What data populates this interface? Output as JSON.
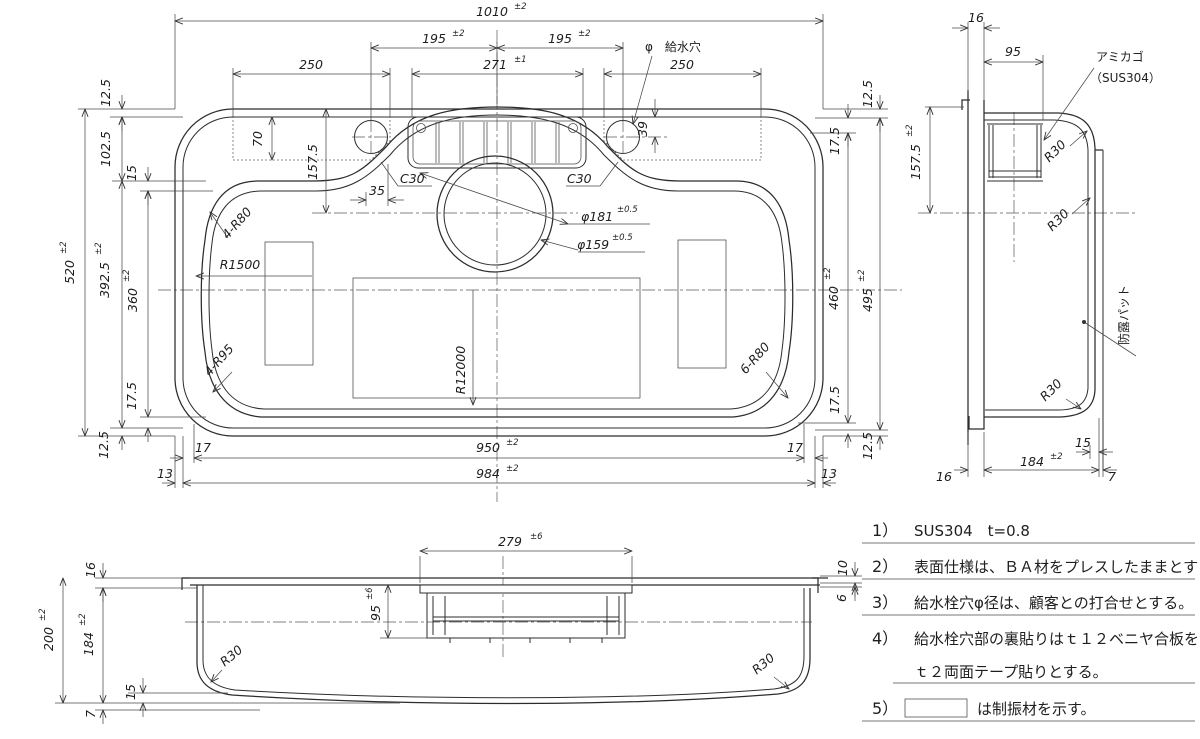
{
  "plan": {
    "w1010": {
      "v": "1010",
      "t": "±2"
    },
    "s195l": {
      "v": "195",
      "t": "±2"
    },
    "s195r": {
      "v": "195",
      "t": "±2"
    },
    "faucet": "φ　給水穴",
    "w250l": {
      "v": "250"
    },
    "w271": {
      "v": "271",
      "t": "±1"
    },
    "w250r": {
      "v": "250"
    },
    "h12_5tl": {
      "v": "12.5"
    },
    "h102_5": {
      "v": "102.5"
    },
    "h15": {
      "v": "15"
    },
    "h520": {
      "v": "520",
      "t": "±2"
    },
    "h392_5": {
      "v": "392.5",
      "t": "±2"
    },
    "h360": {
      "v": "360",
      "t": "±2"
    },
    "h70": {
      "v": "70"
    },
    "h157_5": {
      "v": "157.5"
    },
    "w35": {
      "v": "35"
    },
    "c30l": {
      "v": "C30"
    },
    "c30r": {
      "v": "C30"
    },
    "d181": {
      "v": "φ181",
      "t": "±0.5"
    },
    "d159": {
      "v": "φ159",
      "t": "±0.5"
    },
    "r80_4": {
      "v": "4-R80"
    },
    "r1500": {
      "v": "R1500"
    },
    "r95_4": {
      "v": "4-R95"
    },
    "r12000": {
      "v": "R12000"
    },
    "r80_6": {
      "v": "6-R80"
    },
    "h39": {
      "v": "39"
    },
    "h12_5tr": {
      "v": "12.5"
    },
    "h17_5tr": {
      "v": "17.5"
    },
    "h460": {
      "v": "460",
      "t": "±2"
    },
    "h495": {
      "v": "495",
      "t": "±2"
    },
    "h17_5br": {
      "v": "17.5"
    },
    "h12_5br": {
      "v": "12.5"
    },
    "h17_5bl": {
      "v": "17.5"
    },
    "h12_5bl": {
      "v": "12.5"
    },
    "w17l": {
      "v": "17"
    },
    "w950": {
      "v": "950",
      "t": "±2"
    },
    "w17r": {
      "v": "17"
    },
    "w13l": {
      "v": "13"
    },
    "w984": {
      "v": "984",
      "t": "±2"
    },
    "w13r": {
      "v": "13"
    }
  },
  "side": {
    "w16t": {
      "v": "16"
    },
    "w95": {
      "v": "95"
    },
    "basket1": "アミカゴ",
    "basket2": "（SUS304）",
    "h157_5": {
      "v": "157.5",
      "t": "±2"
    },
    "r30a": {
      "v": "R30"
    },
    "r30b": {
      "v": "R30"
    },
    "r30c": {
      "v": "R30"
    },
    "pad": "防露パット",
    "w15": {
      "v": "15"
    },
    "w16b": {
      "v": "16"
    },
    "w184": {
      "v": "184",
      "t": "±2"
    },
    "w7": {
      "v": "7"
    }
  },
  "front": {
    "w279": {
      "v": "279",
      "t": "±6"
    },
    "h16": {
      "v": "16"
    },
    "h200": {
      "v": "200",
      "t": "±2"
    },
    "h184": {
      "v": "184",
      "t": "±2"
    },
    "h95": {
      "v": "95",
      "t": "±6"
    },
    "r30l": {
      "v": "R30"
    },
    "r30r": {
      "v": "R30"
    },
    "h15": {
      "v": "15"
    },
    "h7": {
      "v": "7"
    },
    "h10": {
      "v": "10"
    },
    "h6": {
      "v": "6"
    }
  },
  "notes": {
    "n1no": "1）",
    "n1": "SUS304　t=0.8",
    "n2no": "2）",
    "n2": "表面仕様は、ＢＡ材をプレスしたままとする。",
    "n3no": "3）",
    "n3": "給水栓穴φ径は、顧客との打合せとする。",
    "n4no": "4）",
    "n4a": "給水栓穴部の裏貼りはｔ１２ベニヤ合板を",
    "n4b": "ｔ２両面テープ貼りとする。",
    "n5no": "5）",
    "n5": "は制振材を示す。"
  }
}
